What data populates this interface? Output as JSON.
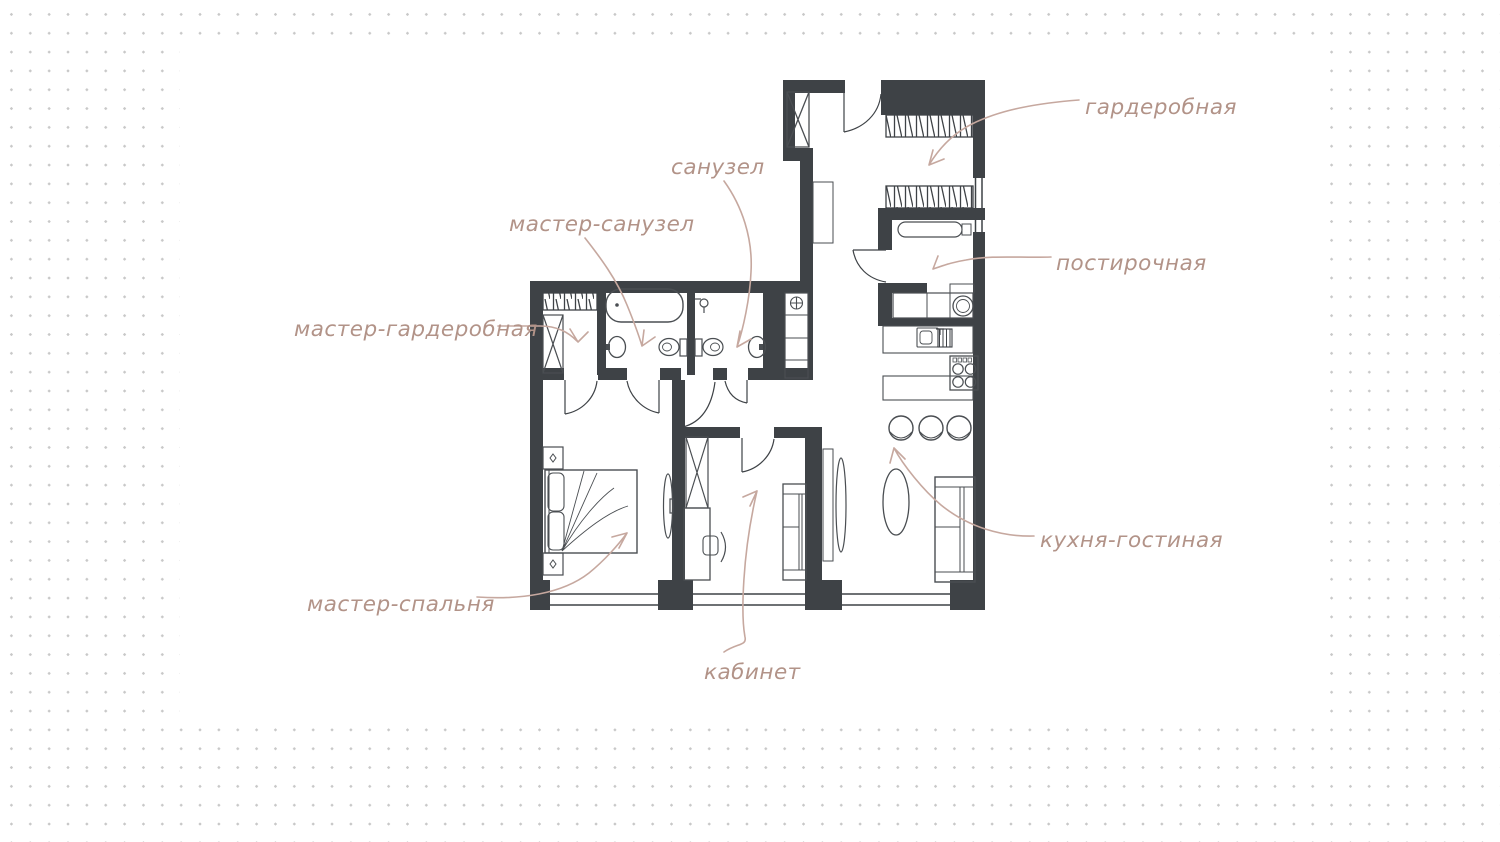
{
  "document": {
    "kind": "apartment-floor-plan-sketch",
    "language": "ru"
  },
  "palette": {
    "wall": "#3e4246",
    "furniture_line": "#4a4e52",
    "label_text": "#b29388",
    "arrow": "#c6a89f",
    "dots": "#c8c8c8",
    "canvas": "#ffffff"
  },
  "labels": {
    "wardrobe": "гардеробная",
    "laundry": "постирочная",
    "kitchen_living": "кухня-гостиная",
    "bathroom": "санузел",
    "master_bathroom": "мастер-санузел",
    "master_wardrobe": "мастер-гардеробная",
    "master_bedroom": "мастер-спальня",
    "office": "кабинет"
  },
  "fixtures": [
    "entrance-door",
    "ventilation-shaft",
    "clothes-rack",
    "ironing-board",
    "washing-machine",
    "laundry-counter",
    "utility-cabinet-fan",
    "kitchen-sink",
    "dish-rack",
    "stove",
    "bar-counter",
    "bar-stool",
    "dining-table",
    "sofa",
    "tv",
    "bathtub",
    "sink",
    "toilet",
    "shower",
    "bed",
    "nightstand",
    "desk",
    "office-chair",
    "window",
    "door"
  ]
}
